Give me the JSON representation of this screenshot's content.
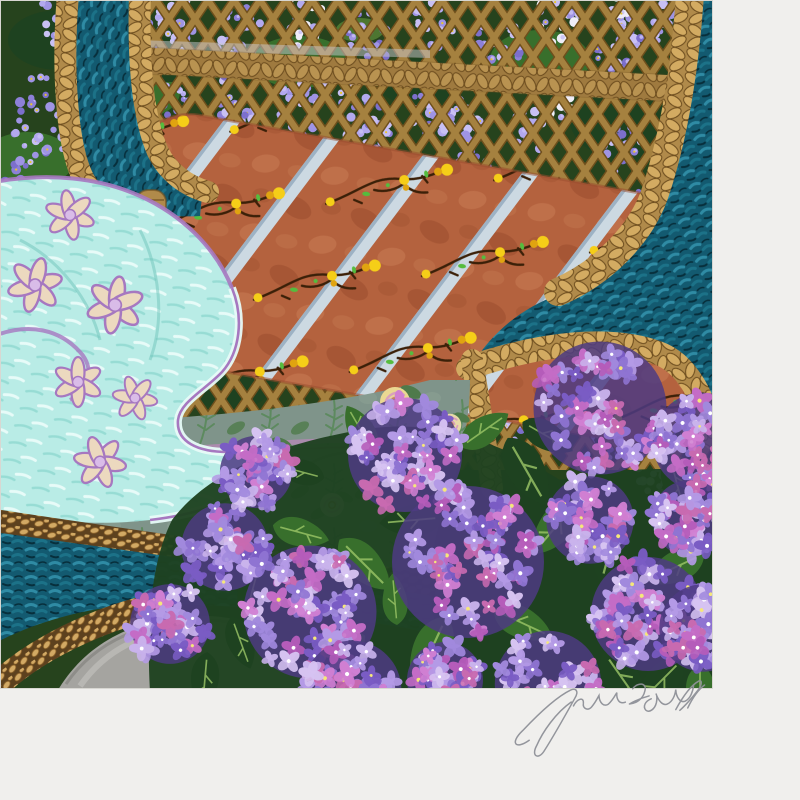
{
  "artwork": {
    "signature": "John Powell",
    "palette": {
      "paper": "#f0efed",
      "edge": "#d8d7d2",
      "bgGreen": "#26431d",
      "leafDark": "#1e4220",
      "leafMid": "#386f2c",
      "leafLight": "#679a3f",
      "leafVein": "#9cc768",
      "lattice": "#a5813f",
      "latticeDark": "#6e4f1c",
      "braid": "#b08a4a",
      "braidLight": "#d3ab62",
      "braidDark": "#6d4d1e",
      "teal": "#135a70",
      "tealLight": "#2f8ba4",
      "tealMid": "#1c7288",
      "tealDark": "#072f3c",
      "ropeDark": "#5d411e",
      "ropeBead": "#d2a964",
      "ropeBeadDark": "#8a6028",
      "cushion": "#b4623e",
      "cushionDark": "#9a4c2e",
      "cushionLight": "#c97e56",
      "ribbon": "#ccd9e2",
      "ribbonShade": "#9db2c4",
      "vineBrown": "#3b2008",
      "vineYellow": "#f5ce18",
      "vineYellowDeep": "#e0a410",
      "vineGreen": "#55bc3e",
      "aqua": "#b9ece6",
      "aquaLight": "#e7fbf8",
      "aquaStreak": "#8fd8d0",
      "aquaDeep": "#6fc4ba",
      "lavender": "#d9bce8",
      "lavenderDeep": "#a678c0",
      "cream": "#ecd9bf",
      "sage": "#7f948a",
      "sageFern": "#5d8a5f",
      "sageLeaf": "#4f7a4a",
      "sageStripe": "#b08ab0",
      "roseCream": "#e8d9a8",
      "rosePink": "#d9a0bc",
      "roseShadow": "#c08858",
      "stone": "#a5a4a0",
      "stoneLight": "#bdbcb8",
      "stoneDark": "#84837f",
      "signature": "#8f9198",
      "wisteriaDot": "#e6c530",
      "wisteriaWhite": "#efedf8",
      "hydrangeaShadow": "#4e3b82",
      "hydrangeaCenter": "#ffffff",
      "hydrangeaCenterYellow": "#f5e77a",
      "wisteria": [
        "#7c6fcc",
        "#8d80d8",
        "#9f94e4",
        "#b3a9ee",
        "#c8c0f4"
      ],
      "hydrangeaViolet": [
        "#7a5cc4",
        "#8f74d2",
        "#a189dd",
        "#b49ae6"
      ],
      "hydrangeaPink": [
        "#b55cba",
        "#c46cc6",
        "#d07fd2",
        "#c86ab0"
      ],
      "hydrangeaPale": [
        "#c9b3ec",
        "#d6c3f1"
      ]
    },
    "wisteria_clusters": [
      [
        45,
        115,
        36,
        0
      ],
      [
        95,
        55,
        30,
        0
      ],
      [
        22,
        208,
        38,
        0
      ],
      [
        105,
        168,
        30,
        1
      ],
      [
        142,
        45,
        24,
        0
      ],
      [
        55,
        290,
        32,
        0
      ],
      [
        14,
        352,
        26,
        0
      ],
      [
        60,
        18,
        22,
        1
      ],
      [
        178,
        25,
        22,
        1
      ],
      [
        238,
        35,
        24,
        0
      ],
      [
        302,
        20,
        22,
        2
      ],
      [
        368,
        42,
        24,
        0
      ],
      [
        432,
        25,
        22,
        1
      ],
      [
        498,
        46,
        24,
        0
      ],
      [
        558,
        16,
        22,
        2
      ],
      [
        618,
        42,
        24,
        0
      ],
      [
        668,
        20,
        20,
        1
      ],
      [
        622,
        14,
        14,
        2
      ],
      [
        175,
        112,
        24,
        0
      ],
      [
        237,
        126,
        26,
        0
      ],
      [
        302,
        106,
        24,
        1
      ],
      [
        370,
        126,
        26,
        0
      ],
      [
        434,
        112,
        24,
        0
      ],
      [
        340,
        86,
        20,
        1
      ],
      [
        230,
        60,
        18,
        0
      ],
      [
        300,
        150,
        16,
        0
      ],
      [
        472,
        186,
        28,
        0
      ],
      [
        524,
        236,
        30,
        0
      ],
      [
        490,
        300,
        28,
        0
      ],
      [
        548,
        352,
        30,
        0
      ],
      [
        508,
        408,
        28,
        0
      ],
      [
        562,
        300,
        26,
        1
      ],
      [
        608,
        256,
        28,
        0
      ],
      [
        648,
        206,
        24,
        0
      ],
      [
        614,
        336,
        28,
        0
      ],
      [
        658,
        388,
        26,
        0
      ],
      [
        604,
        432,
        24,
        0
      ],
      [
        652,
        468,
        24,
        1
      ],
      [
        692,
        422,
        22,
        0
      ],
      [
        698,
        96,
        18,
        1
      ],
      [
        462,
        122,
        20,
        1
      ],
      [
        560,
        95,
        18,
        2
      ],
      [
        620,
        150,
        22,
        0
      ],
      [
        530,
        130,
        18,
        1
      ]
    ],
    "hydrangea_blooms": [
      [
        600,
        408,
        70,
        1
      ],
      [
        702,
        442,
        52,
        0
      ],
      [
        468,
        562,
        80,
        1
      ],
      [
        648,
        614,
        60,
        0
      ],
      [
        405,
        455,
        60,
        1
      ],
      [
        310,
        612,
        70,
        1
      ],
      [
        225,
        547,
        46,
        0
      ],
      [
        170,
        624,
        42,
        0
      ],
      [
        352,
        690,
        52,
        0
      ],
      [
        548,
        684,
        56,
        1
      ],
      [
        703,
        628,
        46,
        0
      ],
      [
        256,
        472,
        38,
        0
      ],
      [
        590,
        520,
        46,
        0
      ],
      [
        690,
        518,
        40,
        1
      ],
      [
        445,
        680,
        40,
        1
      ]
    ],
    "leaves": [
      [
        525,
        468,
        1.2,
        -30
      ],
      [
        558,
        524,
        1.1,
        40
      ],
      [
        415,
        520,
        1.0,
        85
      ],
      [
        362,
        562,
        1.1,
        -45
      ],
      [
        252,
        592,
        0.9,
        15
      ],
      [
        298,
        532,
        0.9,
        -75
      ],
      [
        612,
        542,
        1.2,
        15
      ],
      [
        678,
        566,
        1.0,
        65
      ],
      [
        622,
        678,
        1.1,
        -35
      ],
      [
        432,
        648,
        1.2,
        25
      ],
      [
        205,
        678,
        0.9,
        5
      ],
      [
        520,
        622,
        1.0,
        -65
      ],
      [
        676,
        480,
        0.9,
        -15
      ],
      [
        362,
        432,
        0.85,
        150
      ],
      [
        302,
        472,
        0.8,
        105
      ],
      [
        482,
        432,
        0.9,
        -125
      ],
      [
        662,
        680,
        1.0,
        45
      ],
      [
        395,
        602,
        0.8,
        175
      ],
      [
        545,
        435,
        0.9,
        -60
      ],
      [
        340,
        650,
        1.0,
        60
      ],
      [
        240,
        640,
        0.85,
        -20
      ],
      [
        700,
        690,
        0.9,
        0
      ]
    ],
    "aqua_flowers": [
      [
        70,
        215,
        1.0,
        20
      ],
      [
        35,
        285,
        1.1,
        -15
      ],
      [
        115,
        305,
        1.15,
        40
      ],
      [
        78,
        382,
        1.0,
        -30
      ],
      [
        135,
        398,
        0.9,
        10
      ],
      [
        100,
        462,
        1.05,
        -50
      ]
    ],
    "roses": [
      [
        100,
        490,
        1.2,
        "cream"
      ],
      [
        265,
        455,
        1.05,
        "poppy"
      ],
      [
        395,
        402,
        1.0,
        "yellow"
      ],
      [
        332,
        505,
        0.8,
        "pink"
      ],
      [
        450,
        425,
        0.75,
        "cream"
      ],
      [
        30,
        452,
        0.8,
        "pink"
      ]
    ]
  }
}
